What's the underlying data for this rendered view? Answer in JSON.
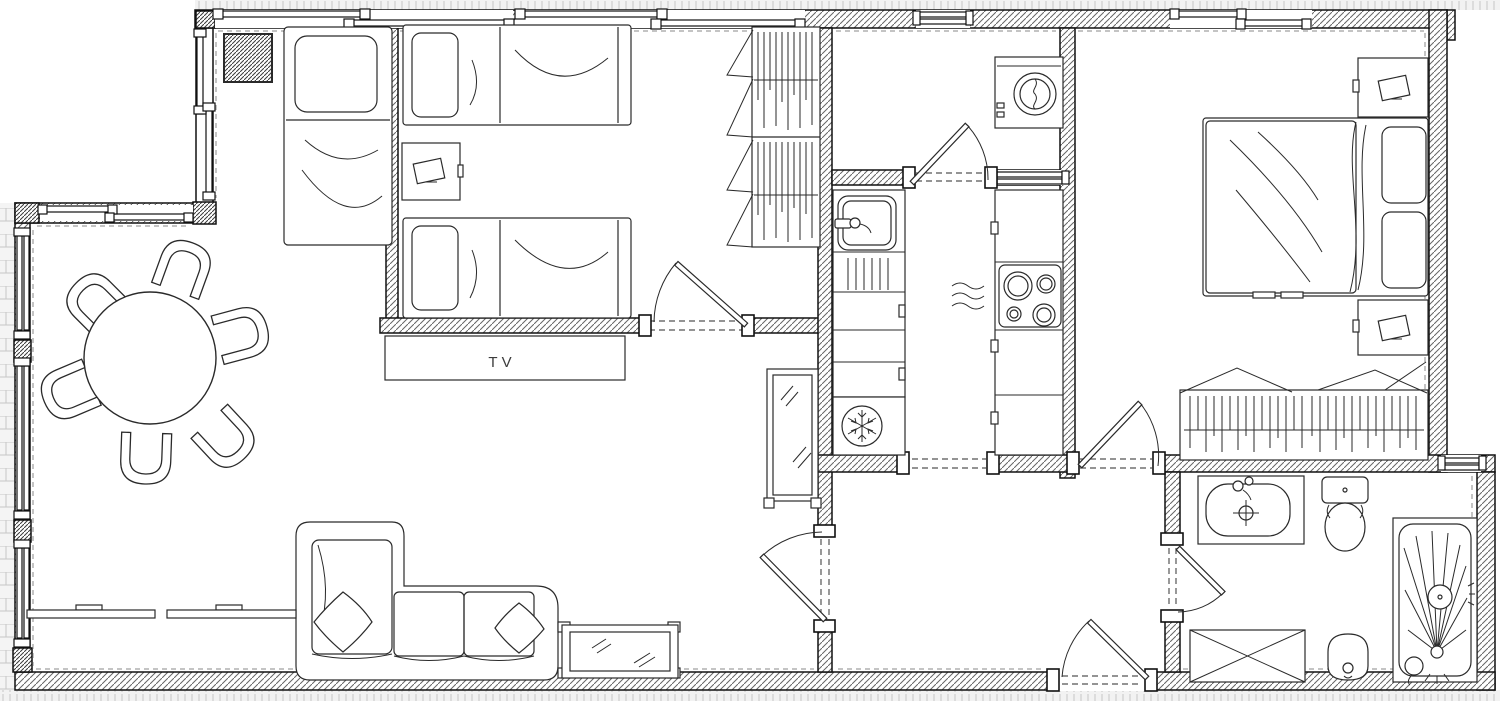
{
  "document": {
    "type": "architectural floor plan",
    "description": "Black-and-white CAD floor plan of an apartment with living-dining room, twin bedroom, sleeping alcove, laundry, kitchen, hallway, master bedroom and bathroom"
  },
  "labels": {
    "tv": "TV"
  },
  "palette": {
    "line": "#2a2a2a",
    "wall_outline": "#111111",
    "wall_hatch": "#666666",
    "floor": "#ffffff",
    "terrace_fill": "#f2f2f2",
    "terrace_line": "#c6c6c6",
    "dash": "#777777"
  },
  "rooms": [
    {
      "id": "living-dining-room",
      "furniture": [
        "round-dining-table",
        "six-dining-chairs",
        "corner-sofa-with-two-cushions",
        "glass-coffee-table",
        "low-sideboard",
        "tv-cabinet",
        "standing-mirror",
        "alcove-single-bed",
        "hatched-column"
      ]
    },
    {
      "id": "twin-bedroom",
      "furniture": [
        "single-bed-top",
        "single-bed-bottom",
        "nightstand-with-lamp",
        "two-wardrobe-units-with-hanging-clothes"
      ]
    },
    {
      "id": "laundry-room",
      "furniture": [
        "washing-machine"
      ]
    },
    {
      "id": "kitchen",
      "furniture": [
        "sink-with-drainer",
        "base-cabinets",
        "four-burner-cooktop",
        "refrigerator-snowflake"
      ]
    },
    {
      "id": "master-bedroom",
      "furniture": [
        "double-bed",
        "nightstand-with-lamp-top",
        "nightstand-with-lamp-bottom",
        "wide-wardrobe-with-hanging-clothes"
      ]
    },
    {
      "id": "hallway",
      "furniture": []
    },
    {
      "id": "bathroom",
      "furniture": [
        "washbasin-with-faucet",
        "toilet",
        "bidet",
        "shower-enclosure",
        "crossed-cabinet"
      ]
    }
  ],
  "doors": [
    "twin-bedroom-door",
    "laundry-door",
    "kitchen-open-passage",
    "master-bedroom-door",
    "living-to-hall-door",
    "bathroom-door",
    "entrance-door"
  ],
  "windows": [
    "top-wall-sliding-window-left",
    "top-wall-sliding-window-center",
    "laundry-window",
    "master-bedroom-window",
    "upper-left-sliding-window",
    "jog-wall-sliding-window",
    "lower-left-sliding-windows",
    "bathroom-window",
    "laundry-kitchen-pass-through"
  ]
}
